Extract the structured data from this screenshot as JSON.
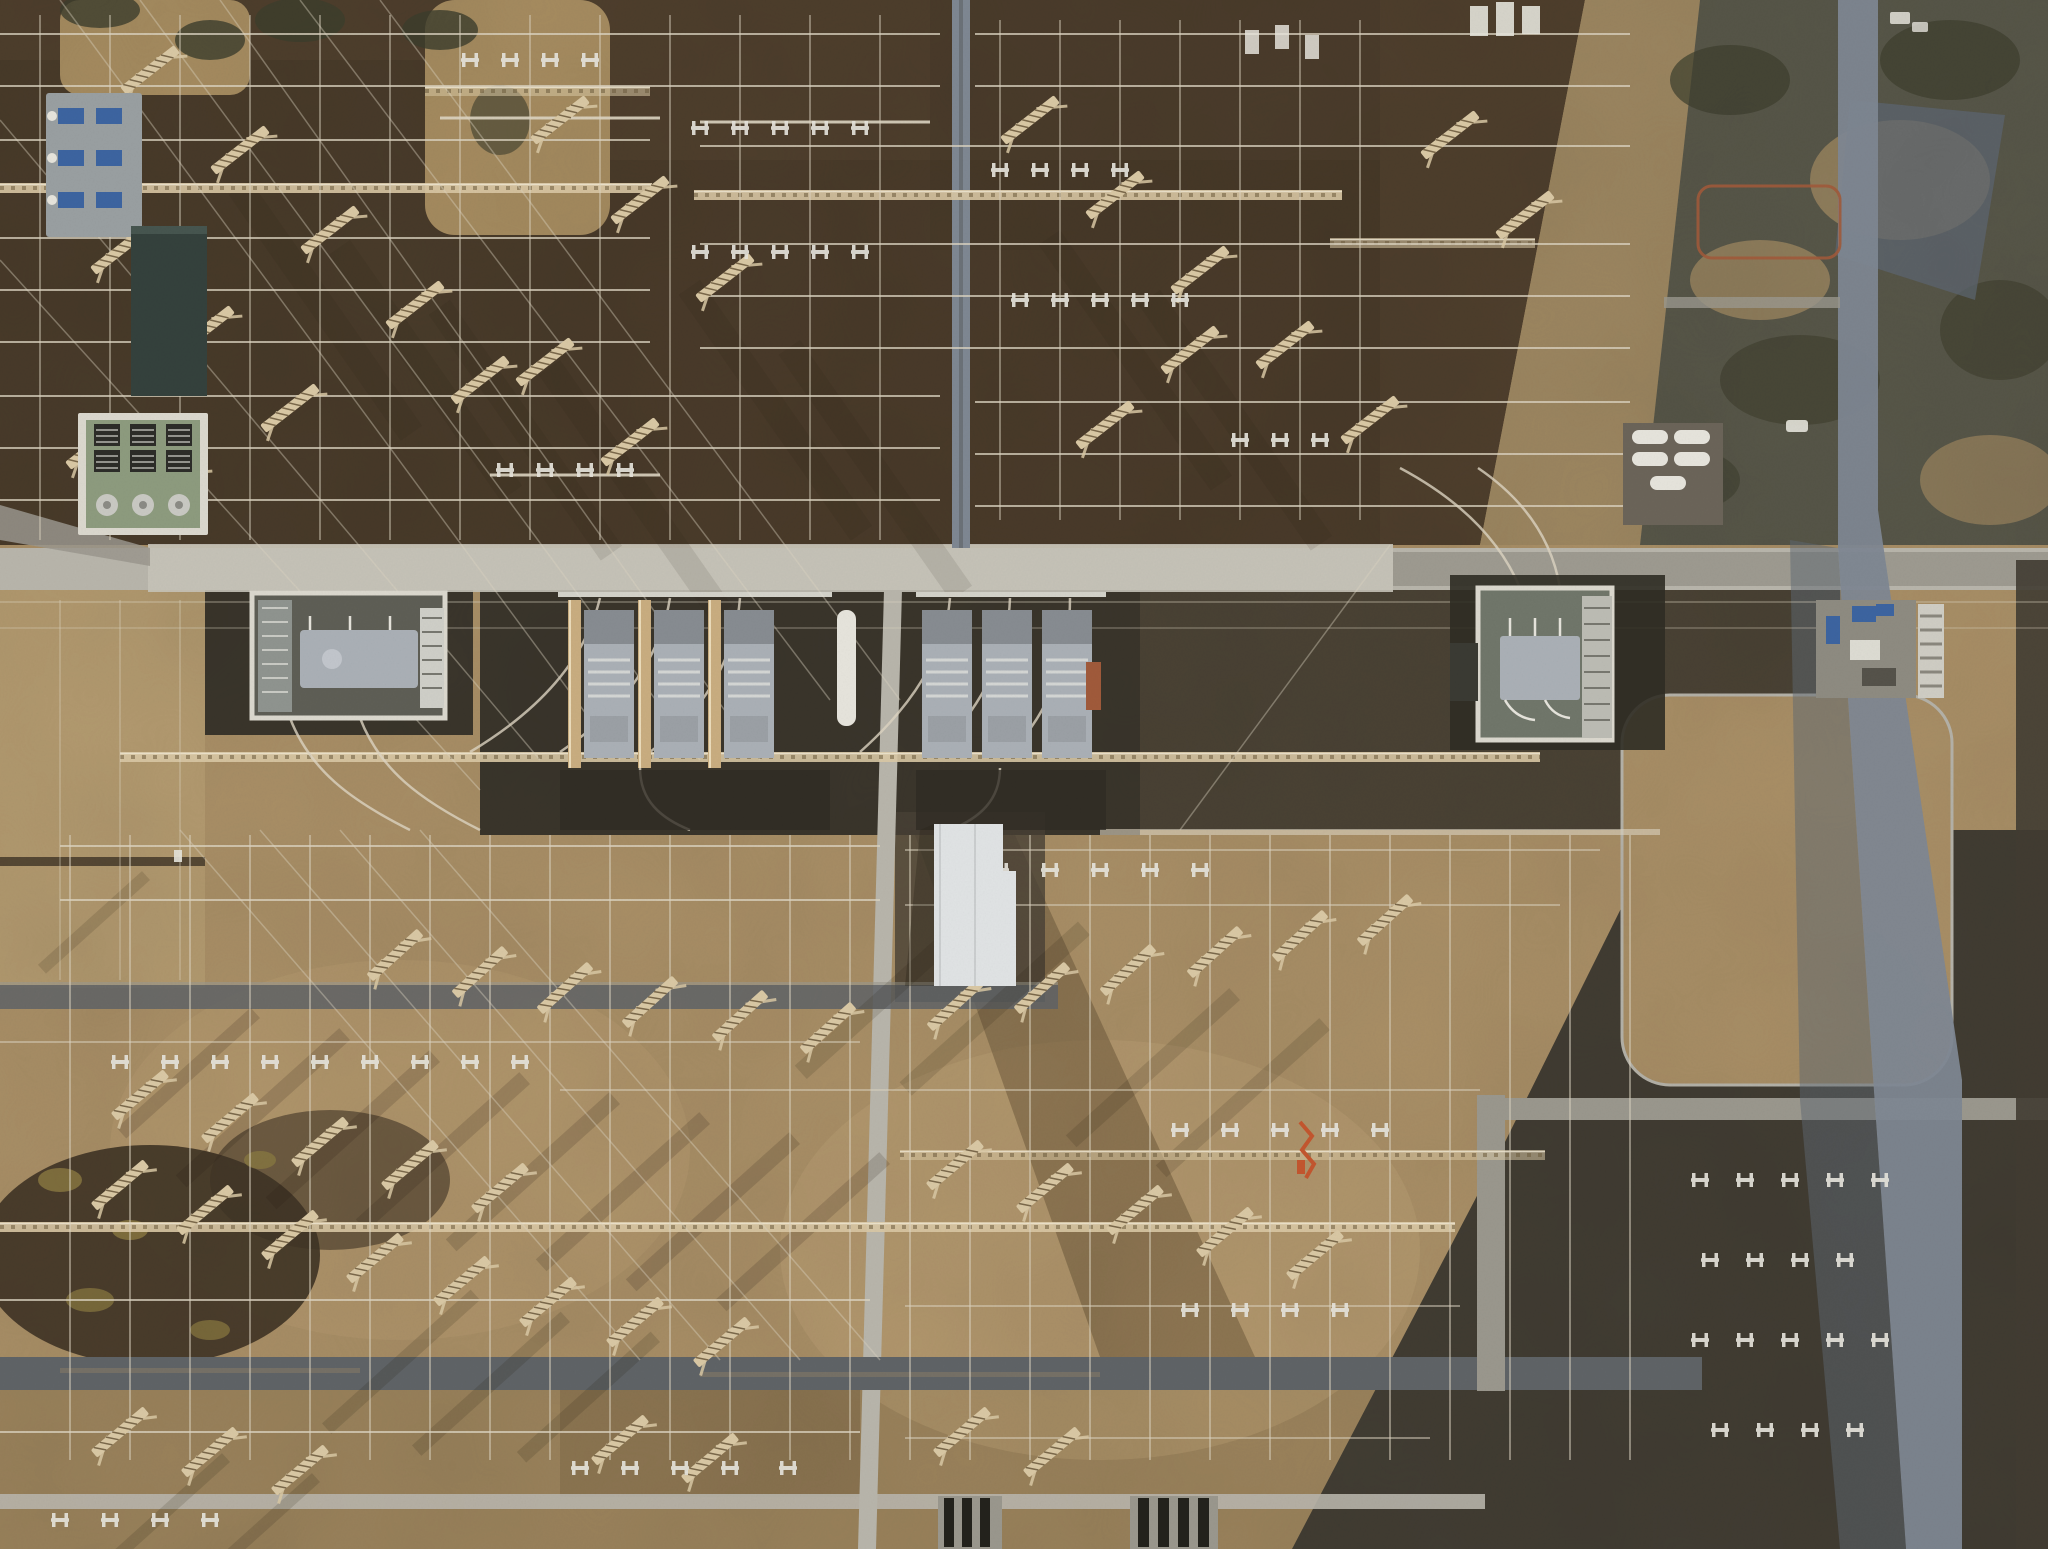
{
  "meta": {
    "scene_type": "aerial-photograph",
    "subject": "high-voltage electrical substation viewed from directly above"
  },
  "palette": {
    "field_gold": "#a98f66",
    "field_light": "#c2a97c",
    "field_dark": "#6f5b3d",
    "soil_top": "#4e3e2c",
    "soil_top_dark": "#3f3325",
    "grass_top": "#a68c60",
    "tree_dark": "#3d3e2d",
    "scrub_base": "#575648",
    "scrub_tan": "#9c8660",
    "shadow_blue": "#5d6772",
    "slate": "#413c32",
    "pad_dark": "#3a352b",
    "pad_darker": "#2f2c24",
    "road_light": "#b8b5ab",
    "road_bright": "#c6c3b8",
    "road_mid": "#9a978d",
    "road_dark": "#5f6366",
    "road_blue": "#7e8792",
    "white": "#e6e4dc",
    "wall_white": "#dbd8ce",
    "lattice": "#d9c8a4",
    "wire": "#ddd5c2",
    "firewall": "#c9ad80",
    "transformer": "#aab0b6",
    "teal_building": "#34413c",
    "green_encl": "#8d9b7e",
    "gray_pad": "#999fa1",
    "blue_equip": "#3c64a0",
    "rust": "#a05a3a",
    "orange": "#c3562e",
    "building_white": "#e0e3e4"
  },
  "scene": {
    "viewport": {
      "w": 2048,
      "h": 1549
    },
    "lattice_rows": [
      [
        0,
        183,
        652
      ],
      [
        694,
        190,
        648
      ],
      [
        425,
        86,
        225,
        1
      ],
      [
        1330,
        238,
        205,
        1
      ],
      [
        120,
        752,
        1420
      ],
      [
        0,
        1222,
        1455
      ],
      [
        900,
        1150,
        645,
        1
      ]
    ],
    "h_wires": [
      [
        0,
        940,
        34
      ],
      [
        975,
        1630,
        34
      ],
      [
        0,
        940,
        86
      ],
      [
        975,
        1630,
        86
      ],
      [
        0,
        650,
        140
      ],
      [
        700,
        1630,
        146
      ],
      [
        440,
        660,
        118,
        0.9,
        3
      ],
      [
        700,
        930,
        122,
        0.9,
        3
      ],
      [
        0,
        650,
        238
      ],
      [
        700,
        1630,
        244
      ],
      [
        0,
        650,
        290
      ],
      [
        700,
        1630,
        296
      ],
      [
        0,
        650,
        342
      ],
      [
        700,
        1630,
        348
      ],
      [
        0,
        940,
        396
      ],
      [
        975,
        1630,
        402
      ],
      [
        0,
        940,
        448
      ],
      [
        975,
        1630,
        454
      ],
      [
        0,
        940,
        500
      ],
      [
        975,
        1630,
        506
      ],
      [
        490,
        660,
        475,
        0.9,
        3
      ],
      [
        0,
        2048,
        602,
        0.3
      ],
      [
        0,
        2048,
        628,
        0.25
      ],
      [
        60,
        880,
        846
      ],
      [
        905,
        1600,
        850,
        0.5
      ],
      [
        60,
        880,
        900
      ],
      [
        905,
        1560,
        905,
        0.5
      ],
      [
        0,
        860,
        1042,
        0.5
      ],
      [
        560,
        1480,
        1090,
        0.5
      ],
      [
        0,
        870,
        1300
      ],
      [
        905,
        1460,
        1306,
        0.5
      ],
      [
        0,
        860,
        1432
      ],
      [
        905,
        1430,
        1438,
        0.5
      ],
      [
        1100,
        1660,
        832,
        0.6,
        6
      ]
    ],
    "v_wires": [
      [
        40,
        15,
        540
      ],
      [
        110,
        15,
        540
      ],
      [
        180,
        15,
        540
      ],
      [
        250,
        15,
        540
      ],
      [
        320,
        15,
        540
      ],
      [
        390,
        15,
        540
      ],
      [
        460,
        15,
        540
      ],
      [
        530,
        15,
        540
      ],
      [
        600,
        15,
        540
      ],
      [
        670,
        15,
        540
      ],
      [
        740,
        15,
        540
      ],
      [
        810,
        15,
        540
      ],
      [
        880,
        15,
        540
      ],
      [
        1000,
        20,
        520
      ],
      [
        1060,
        20,
        520
      ],
      [
        1120,
        20,
        520
      ],
      [
        1180,
        20,
        520
      ],
      [
        1240,
        20,
        520
      ],
      [
        1300,
        20,
        520
      ],
      [
        1360,
        20,
        520
      ],
      [
        70,
        835,
        1460,
        0.5
      ],
      [
        130,
        835,
        1460,
        0.5
      ],
      [
        190,
        835,
        1460,
        0.5
      ],
      [
        250,
        835,
        1460,
        0.5
      ],
      [
        310,
        835,
        1460,
        0.5
      ],
      [
        370,
        835,
        1460,
        0.5
      ],
      [
        430,
        835,
        1460,
        0.5
      ],
      [
        490,
        835,
        1460,
        0.5
      ],
      [
        550,
        835,
        1460,
        0.5
      ],
      [
        610,
        835,
        1460,
        0.5
      ],
      [
        670,
        835,
        1460,
        0.5
      ],
      [
        730,
        835,
        1460,
        0.5
      ],
      [
        790,
        835,
        1460,
        0.5
      ],
      [
        850,
        835,
        1460,
        0.5
      ],
      [
        910,
        835,
        1460,
        0.5
      ],
      [
        970,
        835,
        1460,
        0.5
      ],
      [
        1030,
        835,
        1460,
        0.5
      ],
      [
        1090,
        835,
        1460,
        0.5
      ],
      [
        1150,
        835,
        1460,
        0.5
      ],
      [
        1210,
        835,
        1460,
        0.5
      ],
      [
        1270,
        835,
        1460,
        0.5
      ],
      [
        1330,
        835,
        1460,
        0.5
      ],
      [
        1390,
        835,
        1460,
        0.5
      ],
      [
        1450,
        835,
        1460,
        0.5
      ],
      [
        1510,
        835,
        1460,
        0.5
      ],
      [
        1570,
        835,
        1460,
        0.5
      ],
      [
        1630,
        835,
        1460,
        0.5
      ],
      [
        60,
        600,
        980,
        0.3
      ],
      [
        120,
        600,
        980,
        0.3
      ],
      [
        180,
        600,
        980,
        0.3
      ]
    ],
    "diag_wires": [
      [
        60,
        0,
        620,
        760
      ],
      [
        140,
        0,
        700,
        760
      ],
      [
        220,
        0,
        760,
        760
      ],
      [
        0,
        120,
        540,
        760
      ],
      [
        0,
        260,
        480,
        790
      ],
      [
        300,
        0,
        830,
        700
      ],
      [
        380,
        0,
        900,
        700
      ],
      [
        180,
        830,
        640,
        1360
      ],
      [
        260,
        830,
        720,
        1360
      ],
      [
        340,
        830,
        800,
        1360
      ],
      [
        420,
        830,
        880,
        1360
      ],
      [
        1390,
        545,
        1180,
        830
      ]
    ],
    "towers": [
      [
        150,
        70
      ],
      [
        240,
        150
      ],
      [
        330,
        230
      ],
      [
        415,
        305
      ],
      [
        120,
        250
      ],
      [
        205,
        330
      ],
      [
        290,
        408
      ],
      [
        95,
        445
      ],
      [
        175,
        485
      ],
      [
        480,
        380
      ],
      [
        560,
        120
      ],
      [
        640,
        200
      ],
      [
        725,
        278
      ],
      [
        545,
        362
      ],
      [
        630,
        442
      ],
      [
        1030,
        120
      ],
      [
        1115,
        195
      ],
      [
        1200,
        270
      ],
      [
        1285,
        345
      ],
      [
        1370,
        420
      ],
      [
        1450,
        135
      ],
      [
        1525,
        215
      ],
      [
        1105,
        425
      ],
      [
        1190,
        350
      ],
      [
        395,
        955,
        -42
      ],
      [
        480,
        972,
        -42
      ],
      [
        565,
        988,
        -42
      ],
      [
        650,
        1002,
        -42
      ],
      [
        740,
        1016,
        -42
      ],
      [
        828,
        1028,
        -42
      ],
      [
        955,
        1005,
        -42
      ],
      [
        1042,
        988,
        -42
      ],
      [
        1128,
        970,
        -42
      ],
      [
        1215,
        952,
        -42
      ],
      [
        1300,
        936,
        -42
      ],
      [
        1385,
        920,
        -42
      ],
      [
        140,
        1095,
        -40
      ],
      [
        230,
        1118,
        -40
      ],
      [
        320,
        1142,
        -40
      ],
      [
        410,
        1165,
        -40
      ],
      [
        500,
        1188,
        -40
      ],
      [
        120,
        1185,
        -40
      ],
      [
        205,
        1210,
        -40
      ],
      [
        290,
        1235,
        -40
      ],
      [
        375,
        1258,
        -40
      ],
      [
        462,
        1281,
        -40
      ],
      [
        548,
        1302,
        -40
      ],
      [
        635,
        1322,
        -40
      ],
      [
        722,
        1342,
        -40
      ],
      [
        955,
        1165,
        -40
      ],
      [
        1045,
        1188,
        -40
      ],
      [
        1135,
        1210,
        -40
      ],
      [
        1225,
        1232,
        -40
      ],
      [
        1315,
        1255,
        -40
      ],
      [
        120,
        1432,
        -40
      ],
      [
        210,
        1452,
        -40
      ],
      [
        300,
        1470,
        -40
      ],
      [
        620,
        1440,
        -40
      ],
      [
        710,
        1458,
        -40
      ],
      [
        962,
        1432,
        -40
      ],
      [
        1052,
        1452,
        -40
      ]
    ],
    "switches": [
      [
        700,
        128
      ],
      [
        740,
        128
      ],
      [
        780,
        128
      ],
      [
        820,
        128
      ],
      [
        860,
        128
      ],
      [
        700,
        252
      ],
      [
        740,
        252
      ],
      [
        780,
        252
      ],
      [
        820,
        252
      ],
      [
        860,
        252
      ],
      [
        505,
        470
      ],
      [
        545,
        470
      ],
      [
        585,
        470
      ],
      [
        625,
        470
      ],
      [
        1000,
        170
      ],
      [
        1040,
        170
      ],
      [
        1080,
        170
      ],
      [
        1120,
        170
      ],
      [
        1020,
        300
      ],
      [
        1060,
        300
      ],
      [
        1100,
        300
      ],
      [
        1140,
        300
      ],
      [
        1180,
        300
      ],
      [
        1240,
        440
      ],
      [
        1280,
        440
      ],
      [
        1320,
        440
      ],
      [
        470,
        60
      ],
      [
        510,
        60
      ],
      [
        550,
        60
      ],
      [
        590,
        60
      ],
      [
        950,
        870
      ],
      [
        1000,
        870
      ],
      [
        1050,
        870
      ],
      [
        1100,
        870
      ],
      [
        1150,
        870
      ],
      [
        1200,
        870
      ],
      [
        120,
        1062
      ],
      [
        170,
        1062
      ],
      [
        220,
        1062
      ],
      [
        270,
        1062
      ],
      [
        320,
        1062
      ],
      [
        370,
        1062
      ],
      [
        420,
        1062
      ],
      [
        470,
        1062
      ],
      [
        520,
        1062
      ],
      [
        1180,
        1130
      ],
      [
        1230,
        1130
      ],
      [
        1280,
        1130
      ],
      [
        1330,
        1130
      ],
      [
        1380,
        1130
      ],
      [
        1190,
        1310
      ],
      [
        1240,
        1310
      ],
      [
        1290,
        1310
      ],
      [
        1340,
        1310
      ],
      [
        580,
        1468
      ],
      [
        630,
        1468
      ],
      [
        680,
        1468
      ],
      [
        730,
        1468
      ],
      [
        788,
        1468
      ],
      [
        60,
        1520
      ],
      [
        110,
        1520
      ],
      [
        160,
        1520
      ],
      [
        210,
        1520
      ],
      [
        1700,
        1180
      ],
      [
        1745,
        1180
      ],
      [
        1790,
        1180
      ],
      [
        1835,
        1180
      ],
      [
        1880,
        1180
      ],
      [
        1710,
        1260
      ],
      [
        1755,
        1260
      ],
      [
        1800,
        1260
      ],
      [
        1845,
        1260
      ],
      [
        1700,
        1340
      ],
      [
        1745,
        1340
      ],
      [
        1790,
        1340
      ],
      [
        1835,
        1340
      ],
      [
        1880,
        1340
      ],
      [
        1720,
        1430
      ],
      [
        1765,
        1430
      ],
      [
        1810,
        1430
      ],
      [
        1855,
        1430
      ]
    ],
    "shadows": [
      [
        250,
        180,
        300,
        26,
        0.1,
        55
      ],
      [
        350,
        240,
        300,
        26,
        0.1,
        55
      ],
      [
        450,
        300,
        300,
        26,
        0.1,
        55
      ],
      [
        560,
        360,
        300,
        26,
        0.1,
        55
      ],
      [
        700,
        280,
        300,
        26,
        0.1,
        55
      ],
      [
        800,
        340,
        300,
        26,
        0.1,
        55
      ],
      [
        1060,
        230,
        300,
        26,
        0.1,
        55
      ],
      [
        1160,
        290,
        300,
        26,
        0.1,
        55
      ],
      [
        350,
        1040,
        220,
        16,
        0.16,
        138
      ],
      [
        440,
        1062,
        220,
        16,
        0.16,
        138
      ],
      [
        530,
        1084,
        220,
        16,
        0.16,
        138
      ],
      [
        620,
        1104,
        220,
        16,
        0.16,
        138
      ],
      [
        710,
        1124,
        220,
        16,
        0.16,
        138
      ],
      [
        800,
        1144,
        220,
        16,
        0.16,
        138
      ],
      [
        890,
        1164,
        220,
        16,
        0.16,
        138
      ],
      [
        260,
        1018,
        180,
        14,
        0.16,
        138
      ],
      [
        1000,
        905,
        260,
        18,
        0.14,
        138
      ],
      [
        1090,
        935,
        240,
        18,
        0.14,
        138
      ],
      [
        480,
        1300,
        200,
        14,
        0.15,
        138
      ],
      [
        570,
        1322,
        200,
        14,
        0.15,
        138
      ],
      [
        660,
        1342,
        180,
        14,
        0.15,
        138
      ],
      [
        230,
        1462,
        150,
        12,
        0.15,
        138
      ],
      [
        320,
        1482,
        150,
        12,
        0.15,
        138
      ],
      [
        150,
        880,
        140,
        12,
        0.14,
        138
      ],
      [
        1240,
        1000,
        220,
        16,
        0.14,
        138
      ],
      [
        1330,
        1030,
        220,
        16,
        0.14,
        138
      ]
    ],
    "jumpers": [
      "M600,598 C585,660 540,710 470,752",
      "M670,598 C660,660 620,712 560,752",
      "M740,598 C735,662 700,715 650,752",
      "M950,598 C945,660 905,712 860,752",
      "M1010,598 C1008,662 975,715 935,752",
      "M1070,598 C1070,664 1045,718 1010,752",
      "M640,768 C640,800 660,818 690,830",
      "M1000,768 C1000,800 980,818 950,830",
      "M290,718 C310,770 350,800 410,830",
      "M360,718 C380,770 420,800 480,830",
      "M1520,588 C1500,540 1460,500 1400,468",
      "M1560,588 C1552,540 1525,500 1478,468"
    ],
    "transformer_units": [
      [
        584
      ],
      [
        654
      ],
      [
        724
      ],
      [
        922
      ],
      [
        982
      ],
      [
        1042
      ]
    ],
    "firewalls": [
      [
        568
      ],
      [
        638
      ],
      [
        708
      ]
    ]
  }
}
